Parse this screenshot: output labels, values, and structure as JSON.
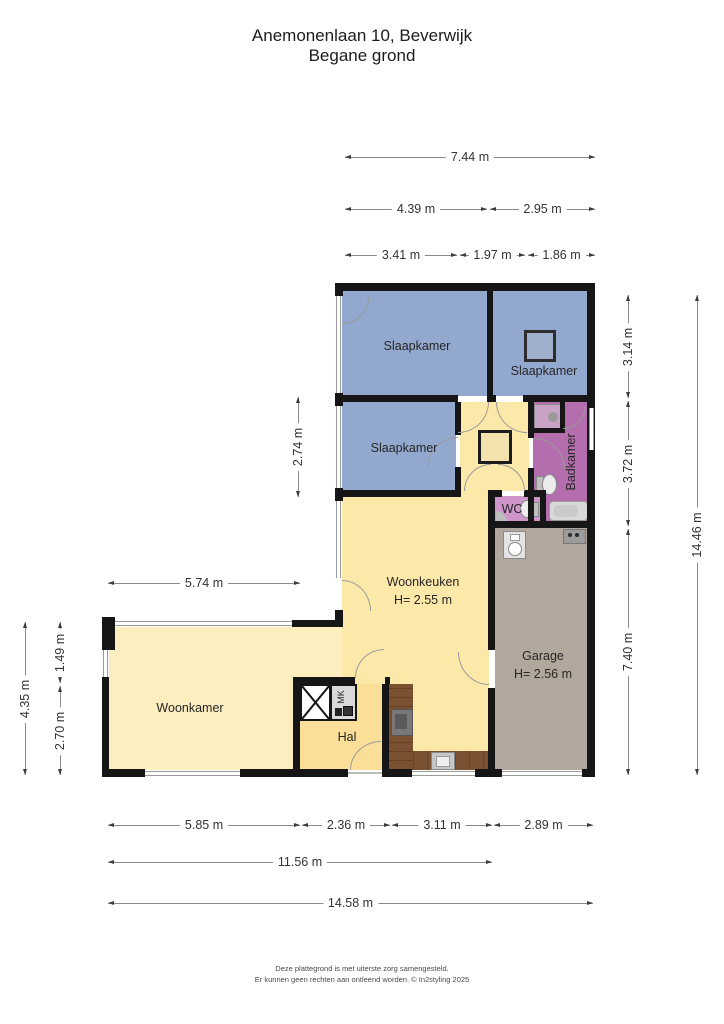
{
  "title": {
    "line1": "Anemonenlaan 10, Beverwijk",
    "line2": "Begane grond"
  },
  "rooms": {
    "slaapkamer1": {
      "label": "Slaapkamer"
    },
    "slaapkamer2": {
      "label": "Slaapkamer"
    },
    "slaapkamer3": {
      "label": "Slaapkamer"
    },
    "badkamer": {
      "label": "Badkamer"
    },
    "wc": {
      "label": "WC"
    },
    "woonkeuken": {
      "label": "Woonkeuken",
      "height": "H= 2.55 m"
    },
    "garage": {
      "label": "Garage",
      "height": "H= 2.56 m"
    },
    "woonkamer": {
      "label": "Woonkamer"
    },
    "hal": {
      "label": "Hal"
    },
    "mk": {
      "label": "MK"
    }
  },
  "dims": {
    "top_total": "7.44 m",
    "top_left": "4.39 m",
    "top_right": "2.95 m",
    "top_bed1": "3.41 m",
    "top_hall": "1.97 m",
    "top_bath": "1.86 m",
    "right_bed": "3.14 m",
    "right_mid": "3.72 m",
    "right_garage": "7.40 m",
    "right_total": "14.46 m",
    "left_bed3": "2.74 m",
    "left_keuken": "5.74 m",
    "left_total": "4.35 m",
    "left_window": "1.49 m",
    "left_lower": "2.70 m",
    "bottom_woonkamer": "5.85 m",
    "bottom_hal": "2.36 m",
    "bottom_keuken": "3.11 m",
    "bottom_garage": "2.89 m",
    "bottom_mid": "11.56 m",
    "bottom_total": "14.58 m"
  },
  "footer": {
    "line1": "Deze plattegrond is met uiterste zorg samengesteld.",
    "line2": "Er kunnen geen rechten aan ontleend worden. © In2styling 2025"
  },
  "colors": {
    "bedroom_blue": "#92a8ce",
    "kitchen_yellow": "#fce8a8",
    "living_yellow": "#fdeec0",
    "hall_yellow": "#fbdf99",
    "bath_purple": "#b46eae",
    "wc_purple": "#cf94ca",
    "garage_taupe": "#b2a79c",
    "wall_black": "#161616",
    "wood": "#7a5232",
    "window_gray": "#9a9a9a",
    "dim_line": "#8a8a8a",
    "fixture_gray": "#dedede"
  }
}
